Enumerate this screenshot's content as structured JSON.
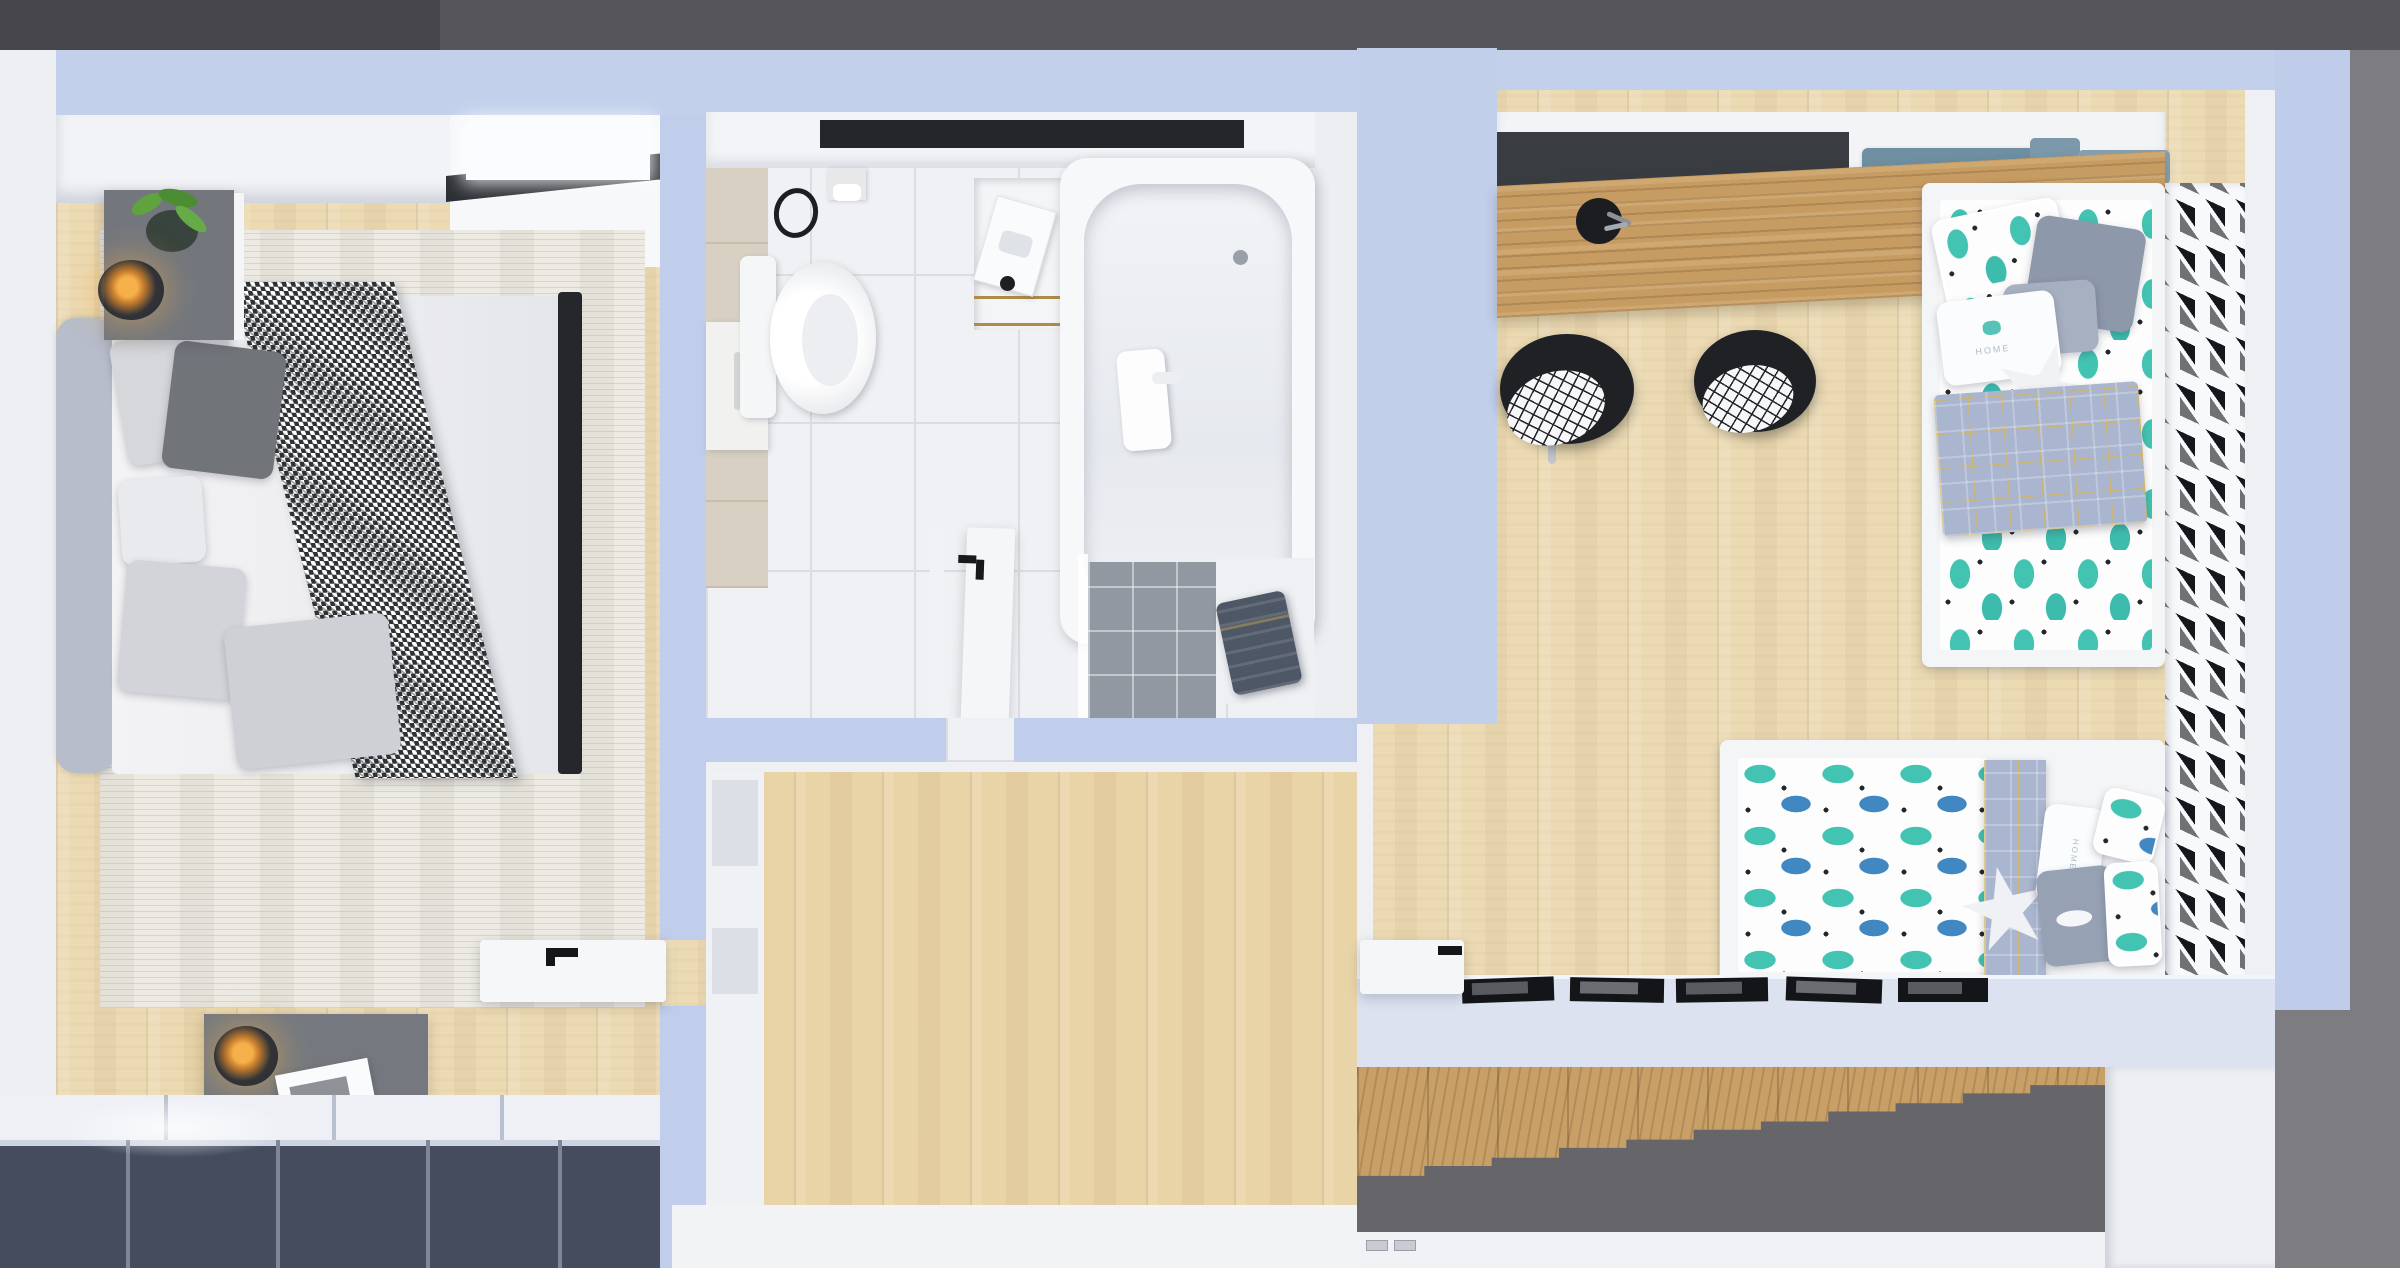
{
  "scene": {
    "description": "Top-down 3D architectural render of an apartment upper floor with bedroom, bathroom, hallway, kids room and a staircase",
    "background": {
      "top_band": "#55555a",
      "top_left_corner": "#46464a",
      "right_area": "#7d7d81"
    },
    "palette": {
      "wall": "#c3d0ec",
      "outer_wall_white": "#edeff3",
      "wood_floor": "#ecdab2",
      "hall_wood": "#e9d4a8",
      "desk_wood": "#c69c63",
      "stair_wood": "#c89f66",
      "rug": "#eceae3",
      "wardrobe_front": "#454c5e",
      "dark_panel": "#393c41",
      "bath_tile": "#f0f1f4",
      "beige_tile": "#d8d1c3",
      "shower_tile": "#9298a2",
      "teal_cactus": "#43c3b2",
      "blue_cactus": "#4187c2",
      "plaid_blue": "#aab6cf",
      "towel": "#4e5765",
      "stair_shadow": "#66666a",
      "lamp_glow": "#f5b04a"
    },
    "rooms": {
      "bedroom": {
        "name": "bedroom",
        "items": [
          "double bed with white duvet",
          "houndstooth throw blanket",
          "gray upholstered headboard",
          "five gray pillows",
          "nightstand with plant and glass globe lamp",
          "nightstand with glass globe lamp and magazine",
          "ivory area rug",
          "navy wardrobe with white top panels and spotlight",
          "white closet with lit panel",
          "open white door with black handle"
        ]
      },
      "bathroom": {
        "name": "bathroom",
        "items": [
          "wall-hung toilet",
          "toilet paper holder",
          "black towel ring",
          "beige tile strip",
          "wall cabinet with handle",
          "vanity sink with lit mirror and cosmetics",
          "niche shelf with tissue box and gold frame",
          "bathtub with hand shower and drain",
          "walk-in shower with gray tiles",
          "white bench with folded dark towel",
          "open white door with black handle",
          "ceiling vent slot"
        ]
      },
      "hallway": {
        "name": "hallway",
        "items": [
          "wood plank floor",
          "two door frames",
          "white landing band",
          "light switches"
        ]
      },
      "kids_room": {
        "name": "kids room",
        "items": [
          "long wooden desk",
          "black desk back panel",
          "two black stools with cross-pattern cushions",
          "pencil cups",
          "toy crane",
          "book on desk",
          "vertical bed with cactus bedding",
          "horizontal daybed with cactus duvet",
          "plaid blankets",
          "star pillows",
          "HOME pillows",
          "white panel with triangle cutouts",
          "ledge with five black frames",
          "open white door"
        ]
      },
      "staircase": {
        "name": "staircase",
        "items": [
          "wooden treads descending to lower floor"
        ]
      }
    },
    "texts": {
      "book_title_line1": "KAYAKFISHING:",
      "book_title_line2": "The Revolution",
      "pillow_word": "HOME"
    }
  }
}
